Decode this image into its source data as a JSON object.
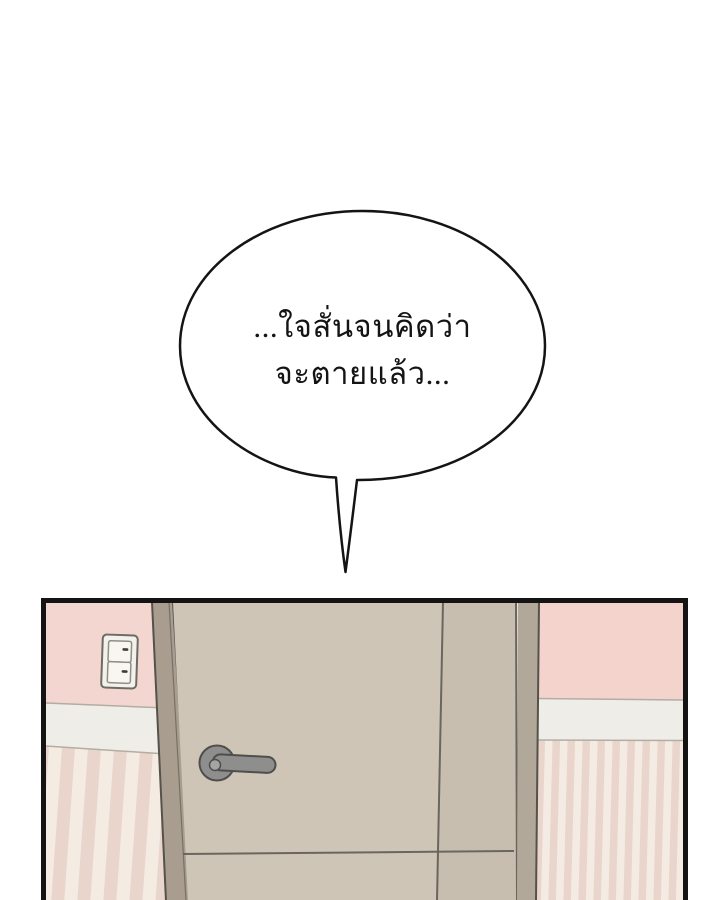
{
  "bubble": {
    "lines": [
      "...ใจสั่นจนคิดว่า",
      "จะตายแล้ว..."
    ]
  },
  "colors": {
    "ink": "#141414",
    "bubble-fill": "#ffffff",
    "pink-wall": "#f2d6cf",
    "pink-wall-right": "#f3d3cb",
    "band": "#efede7",
    "stripe-light": "#f4ebe2",
    "stripe-pink": "#ead5cd",
    "frame": "#a89d8f",
    "frame-right": "#b2a899",
    "frame-line": "#55524b",
    "door": "#cec5b7",
    "door-shade": "#c8beb0",
    "door-line": "#6a665e",
    "handle": "#8e8e8c",
    "handle-dark": "#4e4e4c",
    "handle-light": "#a5a5a3",
    "plate": "#f3f1ec",
    "plate-border": "#6e6b63",
    "rocker": "#f8f6f1",
    "rocker-border": "#928e86",
    "dash": "#3f3c37"
  }
}
